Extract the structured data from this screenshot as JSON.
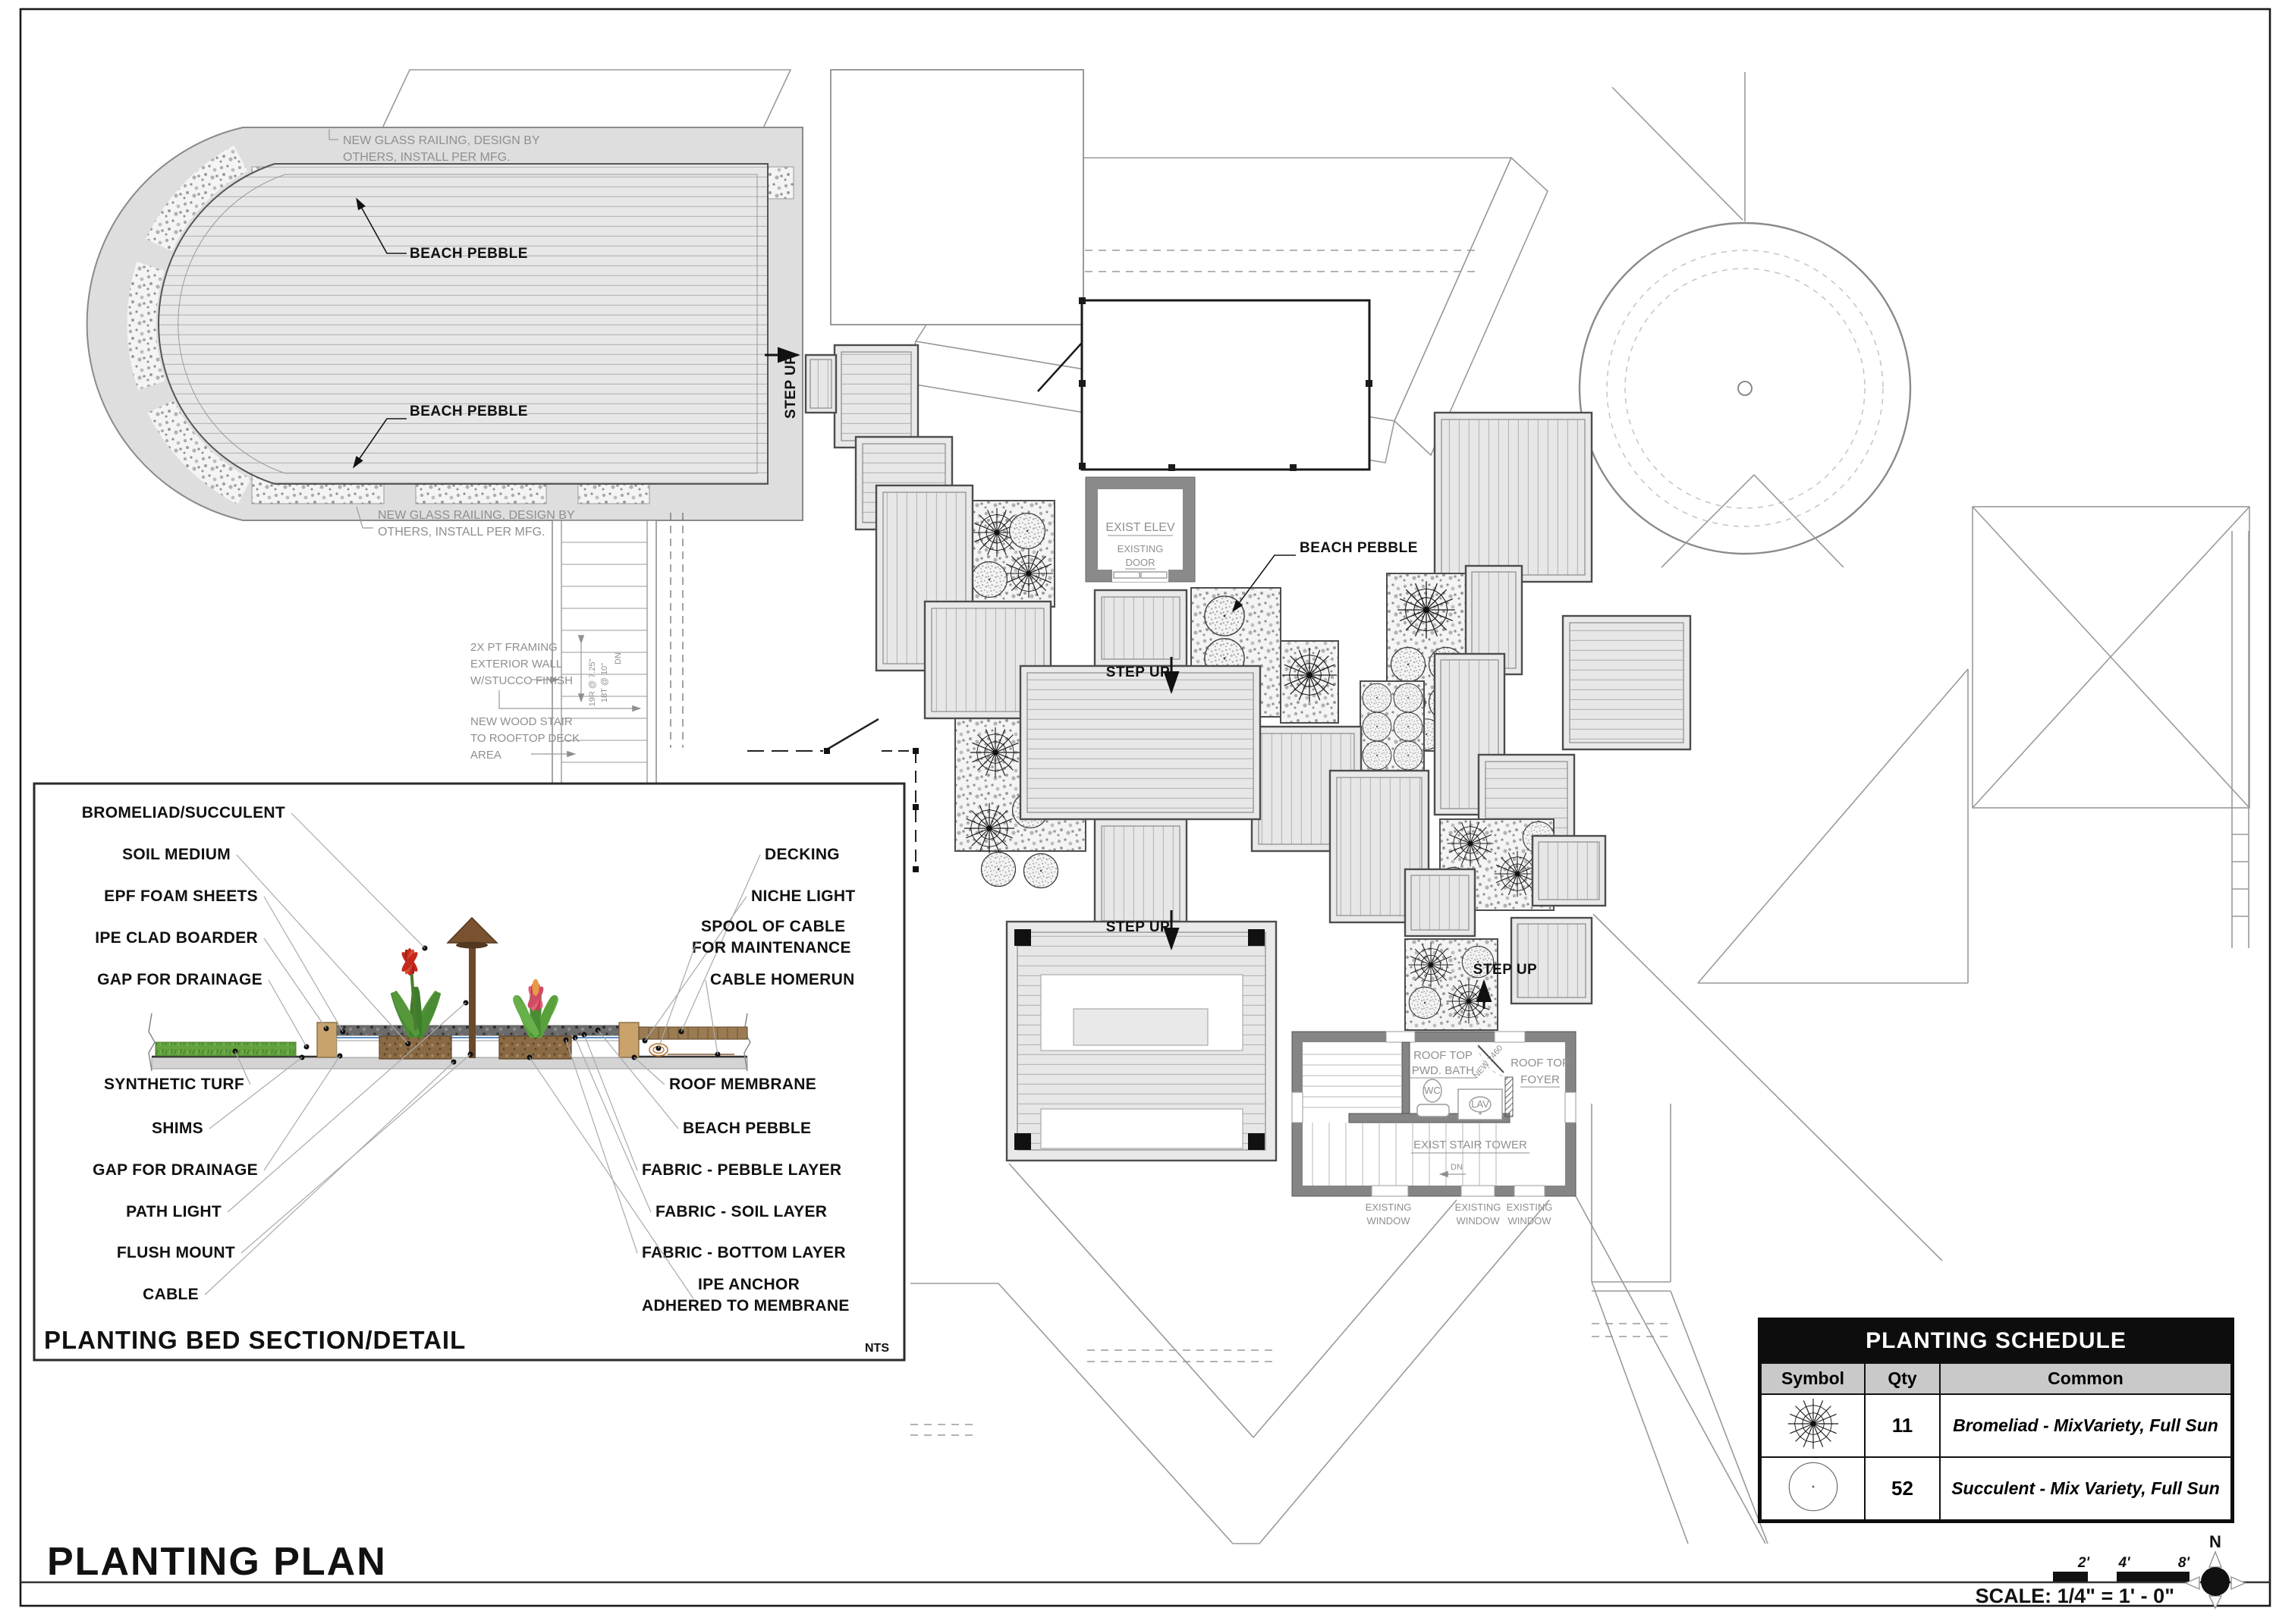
{
  "sheet": {
    "title": "PLANTING PLAN",
    "scale_label": "SCALE: 1/4\" = 1' - 0\"",
    "north_label": "N",
    "nts": "NTS",
    "scale_ticks": [
      "2'",
      "4'",
      "8'"
    ]
  },
  "plan": {
    "step_up": "STEP UP",
    "beach_pebble": "BEACH PEBBLE",
    "glass_railing_1": "NEW GLASS RAILING, DESIGN BY",
    "glass_railing_2": "OTHERS, INSTALL PER MFG.",
    "framing_1": "2X PT FRAMING",
    "framing_2": "EXTERIOR WALL",
    "framing_3": "W/STUCCO FINISH",
    "wood_stair_1": "NEW WOOD STAIR",
    "wood_stair_2": "TO ROOFTOP DECK",
    "wood_stair_3": "AREA",
    "risers": "19R @ 7.25\"",
    "treads": "18T @ 10\"",
    "dn": "DN",
    "exist_elev": "EXIST ELEV",
    "existing": "EXISTING",
    "door": "DOOR",
    "rooftop": "ROOF TOP",
    "pwd_bath": "PWD. BATH",
    "foyer": "FOYER",
    "wc": "WC",
    "lav": "LAV",
    "new_door": "NEW 2460",
    "exist_stair_tower": "EXIST STAIR TOWER",
    "window": "WINDOW"
  },
  "section": {
    "title": "PLANTING BED SECTION/DETAIL",
    "labels_left": [
      "BROMELIAD/SUCCULENT",
      "SOIL MEDIUM",
      "EPF FOAM SHEETS",
      "IPE CLAD BOARDER",
      "GAP FOR DRAINAGE",
      "SYNTHETIC TURF",
      "SHIMS",
      "GAP FOR DRAINAGE",
      "PATH LIGHT",
      "FLUSH MOUNT",
      "CABLE"
    ],
    "labels_right": [
      "DECKING",
      "NICHE LIGHT",
      "SPOOL OF CABLE",
      "FOR MAINTENANCE",
      "CABLE HOMERUN",
      "ROOF MEMBRANE",
      "BEACH PEBBLE",
      "FABRIC - PEBBLE LAYER",
      "FABRIC - SOIL LAYER",
      "FABRIC - BOTTOM LAYER",
      "IPE ANCHOR",
      "ADHERED TO MEMBRANE"
    ]
  },
  "schedule": {
    "title": "PLANTING SCHEDULE",
    "headers": [
      "Symbol",
      "Qty",
      "Common"
    ],
    "rows": [
      {
        "symbol": "bromeliad",
        "qty": "11",
        "common": "Bromeliad - MixVariety, Full Sun"
      },
      {
        "symbol": "succulent",
        "qty": "52",
        "common": "Succulent - Mix Variety, Full Sun"
      }
    ]
  },
  "colors": {
    "leaf_green": "#4a8c33",
    "flower_red": "#c4291c",
    "flower_pink": "#e2637a",
    "wood_brown": "#9a7b52",
    "turf_green": "#63a23e",
    "pebble_gray": "#b5b5b5"
  }
}
